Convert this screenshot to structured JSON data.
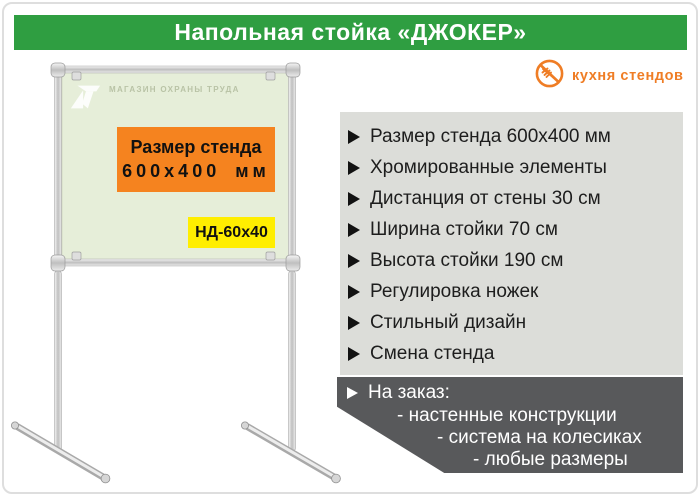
{
  "header": {
    "title": "Напольная стойка «ДЖОКЕР»",
    "bg_color": "#2f9e41",
    "text_color": "#ffffff"
  },
  "brand": {
    "name": "кухня стендов",
    "color": "#ef7d25",
    "icon": "crossed-fork-icon"
  },
  "board": {
    "panel_color": "#e6eed9",
    "frame_color": "#c9c9c9",
    "watermark_text": "МАГАЗИН ОХРАНЫ ТРУДА",
    "size_box": {
      "line1": "Размер стенда",
      "line2": "600х400 мм",
      "bg_color": "#f5831f"
    },
    "code_box": {
      "text": "НД-60х40",
      "bg_color": "#ffee00"
    }
  },
  "features": {
    "bg_color": "#dcddd9",
    "bullet_color": "#121212",
    "items": [
      "Размер стенда 600х400 мм",
      "Хромированные элементы",
      "Дистанция от стены 30 см",
      "Ширина стойки 70 см",
      "Высота стойки 190 см",
      "Регулировка ножек",
      "Стильный дизайн",
      "Смена стенда"
    ]
  },
  "custom_order": {
    "bg_color": "#58595b",
    "title": "На заказ:",
    "items": [
      "- настенные конструкции",
      "- система на колесиках",
      "- любые размеры"
    ]
  }
}
